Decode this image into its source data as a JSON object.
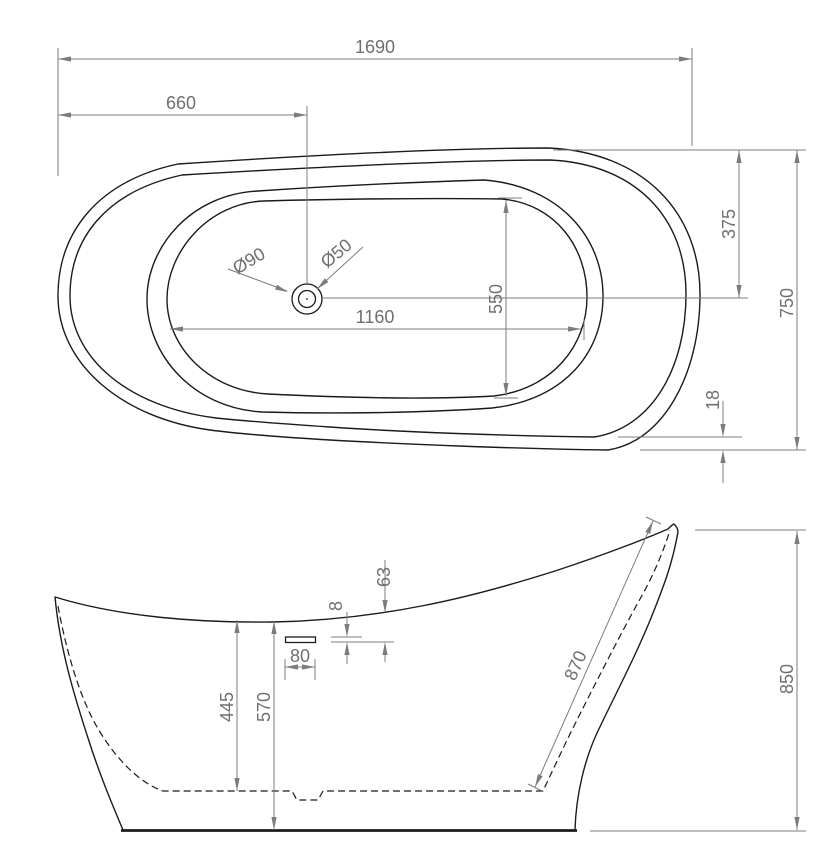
{
  "drawing": {
    "subject": "Freestanding slipper bathtub technical dimension drawing",
    "views": {
      "top": "top view",
      "side": "side profile view"
    },
    "palette": {
      "outline": "#1b1b1b",
      "dimension_lines": "#7c7c7c",
      "background": "#ffffff"
    }
  },
  "top_view": {
    "overall_length": "1690",
    "drain_center_from_left": "660",
    "overall_width": "750",
    "rim_to_centerline": "375",
    "rim_lip_gap": "18",
    "inner_basin_length": "1160",
    "inner_basin_width": "550",
    "drain_recess_diameter": "Ø90",
    "drain_hole_diameter": "Ø50"
  },
  "side_view": {
    "overall_height": "850",
    "front_rim_height": "570",
    "inner_depth": "445",
    "back_slope_length": "870",
    "overflow_slot_width": "80",
    "overflow_slot_height": "8",
    "overflow_drop_from_rim": "63"
  }
}
